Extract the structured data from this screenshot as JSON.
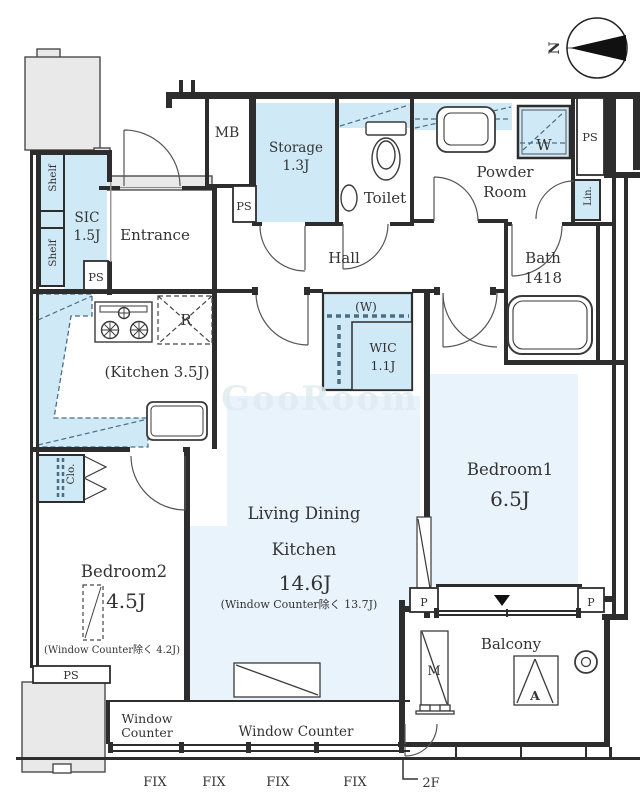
{
  "colors": {
    "wall": "#2d2d2d",
    "fixture_fill": "#cfe9f7",
    "room_fill": "#e9f3fb",
    "neighbor_fill": "#e9e9e9",
    "accent_dash": "#4a6e85"
  },
  "compass": {
    "north": "N"
  },
  "labels": {
    "mb": "MB",
    "storage": "Storage",
    "storage_size": "1.3J",
    "ps_storage": "PS",
    "toilet": "Toilet",
    "powder_line1": "Powder",
    "powder_line2": "Room",
    "washer": "W",
    "ps_right": "PS",
    "linen": "Lin.",
    "bath": "Bath",
    "bath_size": "1418",
    "shelf_upper": "Shelf",
    "shelf_lower": "Shelf",
    "sic": "SIC",
    "sic_size": "1.5J",
    "ps_sic": "PS",
    "entrance": "Entrance",
    "hall": "Hall",
    "kitchen": "(Kitchen 3.5J)",
    "refrigerator": "R",
    "wic_washer": "(W)",
    "wic": "WIC",
    "wic_size": "1.1J",
    "bedroom1": "Bedroom1",
    "bedroom1_size": "6.5J",
    "ldk_line1": "Living Dining",
    "ldk_line2": "Kitchen",
    "ldk_size": "14.6J",
    "ldk_note": "(Window Counter除く 13.7J)",
    "bedroom2": "Bedroom2",
    "bedroom2_size": "4.5J",
    "bedroom2_note": "(Window Counter除く 4.2J)",
    "closet": "Clo.",
    "ps_bedroom2": "PS",
    "window_counter_line1": "Window",
    "window_counter_line2": "Counter",
    "window_counter": "Window Counter",
    "balcony": "Balcony",
    "meter": "M",
    "aircon": "A",
    "pipe_left": "P",
    "pipe_right": "P",
    "fix1": "FIX",
    "fix2": "FIX",
    "fix3": "FIX",
    "fix4": "FIX",
    "floor": "2F",
    "watermark": "GooRoom"
  }
}
